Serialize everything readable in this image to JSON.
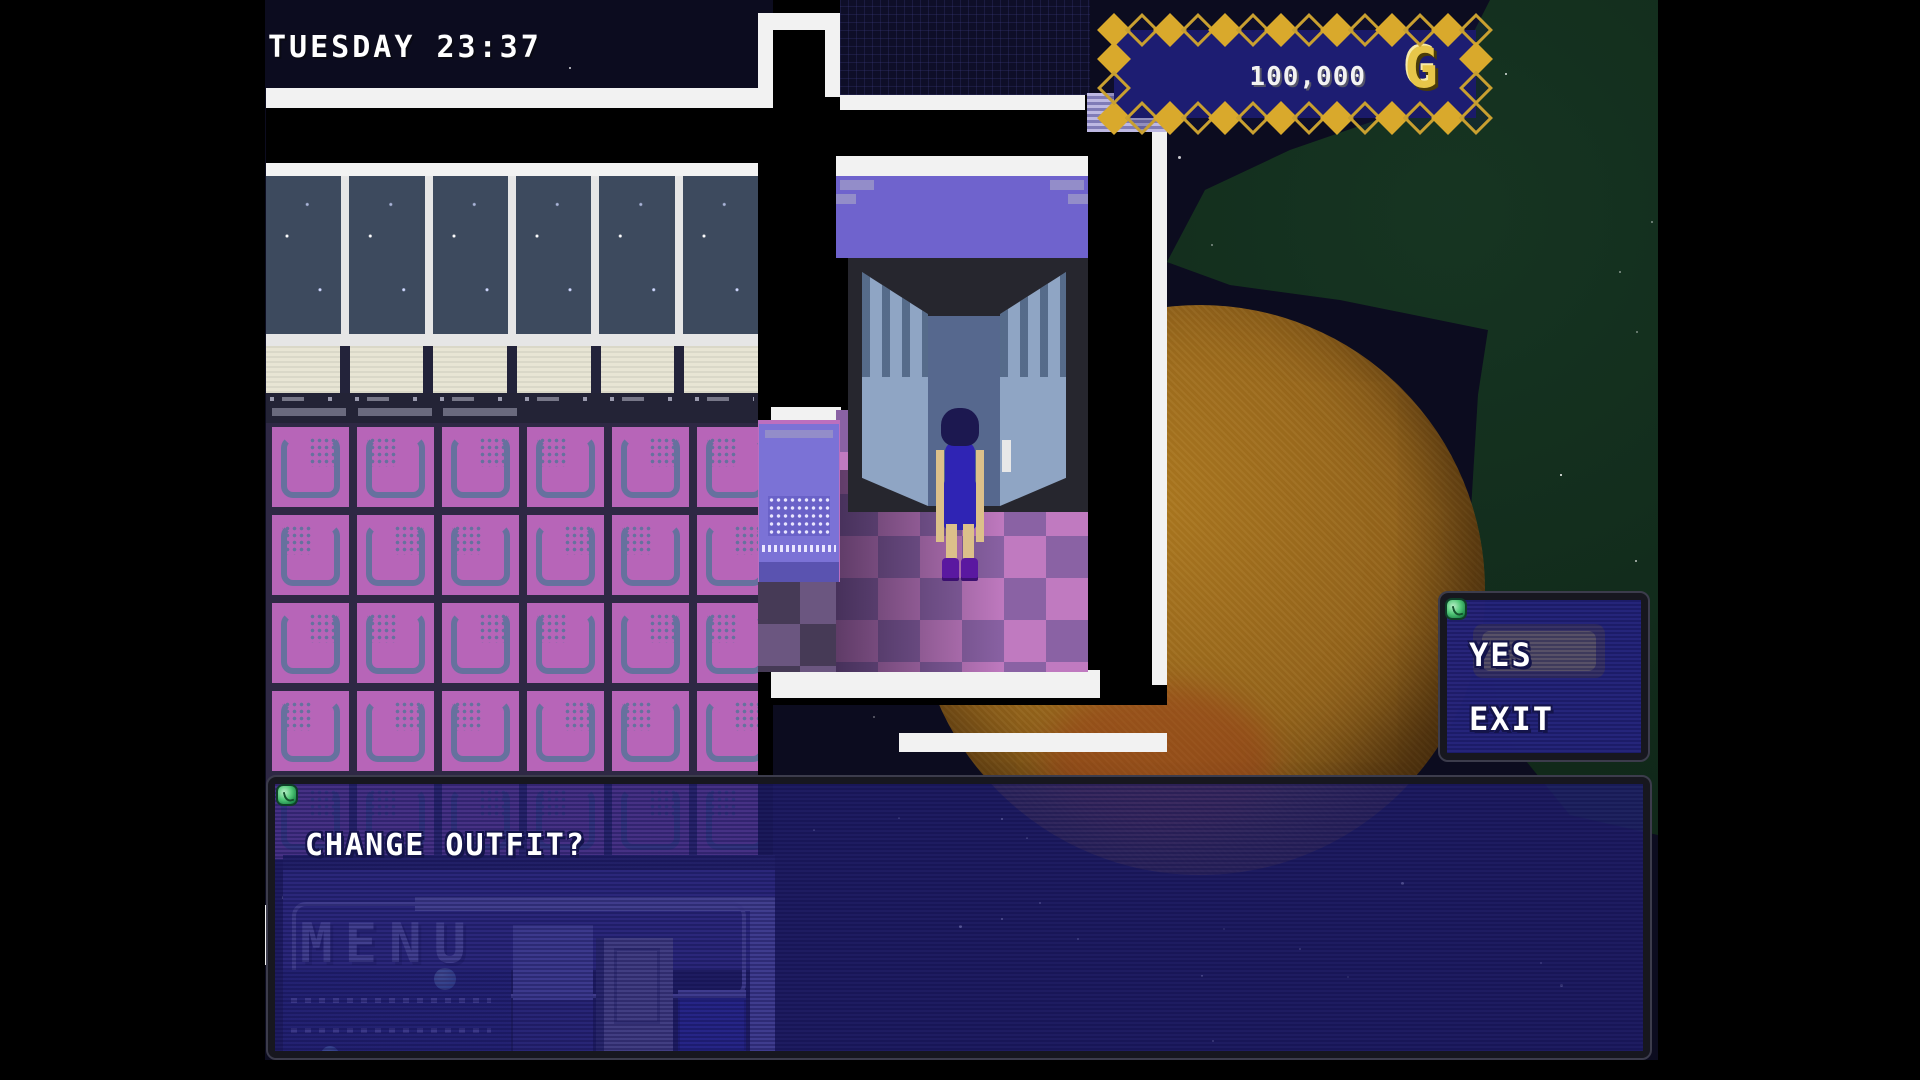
{
  "hud": {
    "clock": "TUESDAY 23:37",
    "money": "100,000",
    "currency_symbol": "G"
  },
  "prompt_dialog": {
    "question": "CHANGE OUTFIT?",
    "gem_icon": "gem-icon"
  },
  "choice_dialog": {
    "gem_icon": "gem-icon",
    "selected_index": 0,
    "options": [
      {
        "label": "YES"
      },
      {
        "label": "EXIT"
      }
    ]
  },
  "menu_button": {
    "label": "MENU"
  },
  "scene": {
    "location": "outfit-shop-changing-room",
    "objects": [
      "wardrobe",
      "player-character",
      "fitting-kiosk",
      "terminal-machine",
      "planet",
      "nebula",
      "starfield"
    ]
  },
  "colors": {
    "accent_gold": "#d9a92c",
    "hud_navy": "#1d1d72",
    "dialog_navy": "#2b2b8e",
    "selection_yellow": "#c9b944",
    "floor_pink": "#b765b8",
    "checker_pink": "#c07ac0",
    "checker_purple": "#8a62a4",
    "awning_purple": "#6f63cd",
    "planet_orange": "#9a6a1e",
    "nebula_green": "#0e2316",
    "gem_green": "#52c878"
  }
}
